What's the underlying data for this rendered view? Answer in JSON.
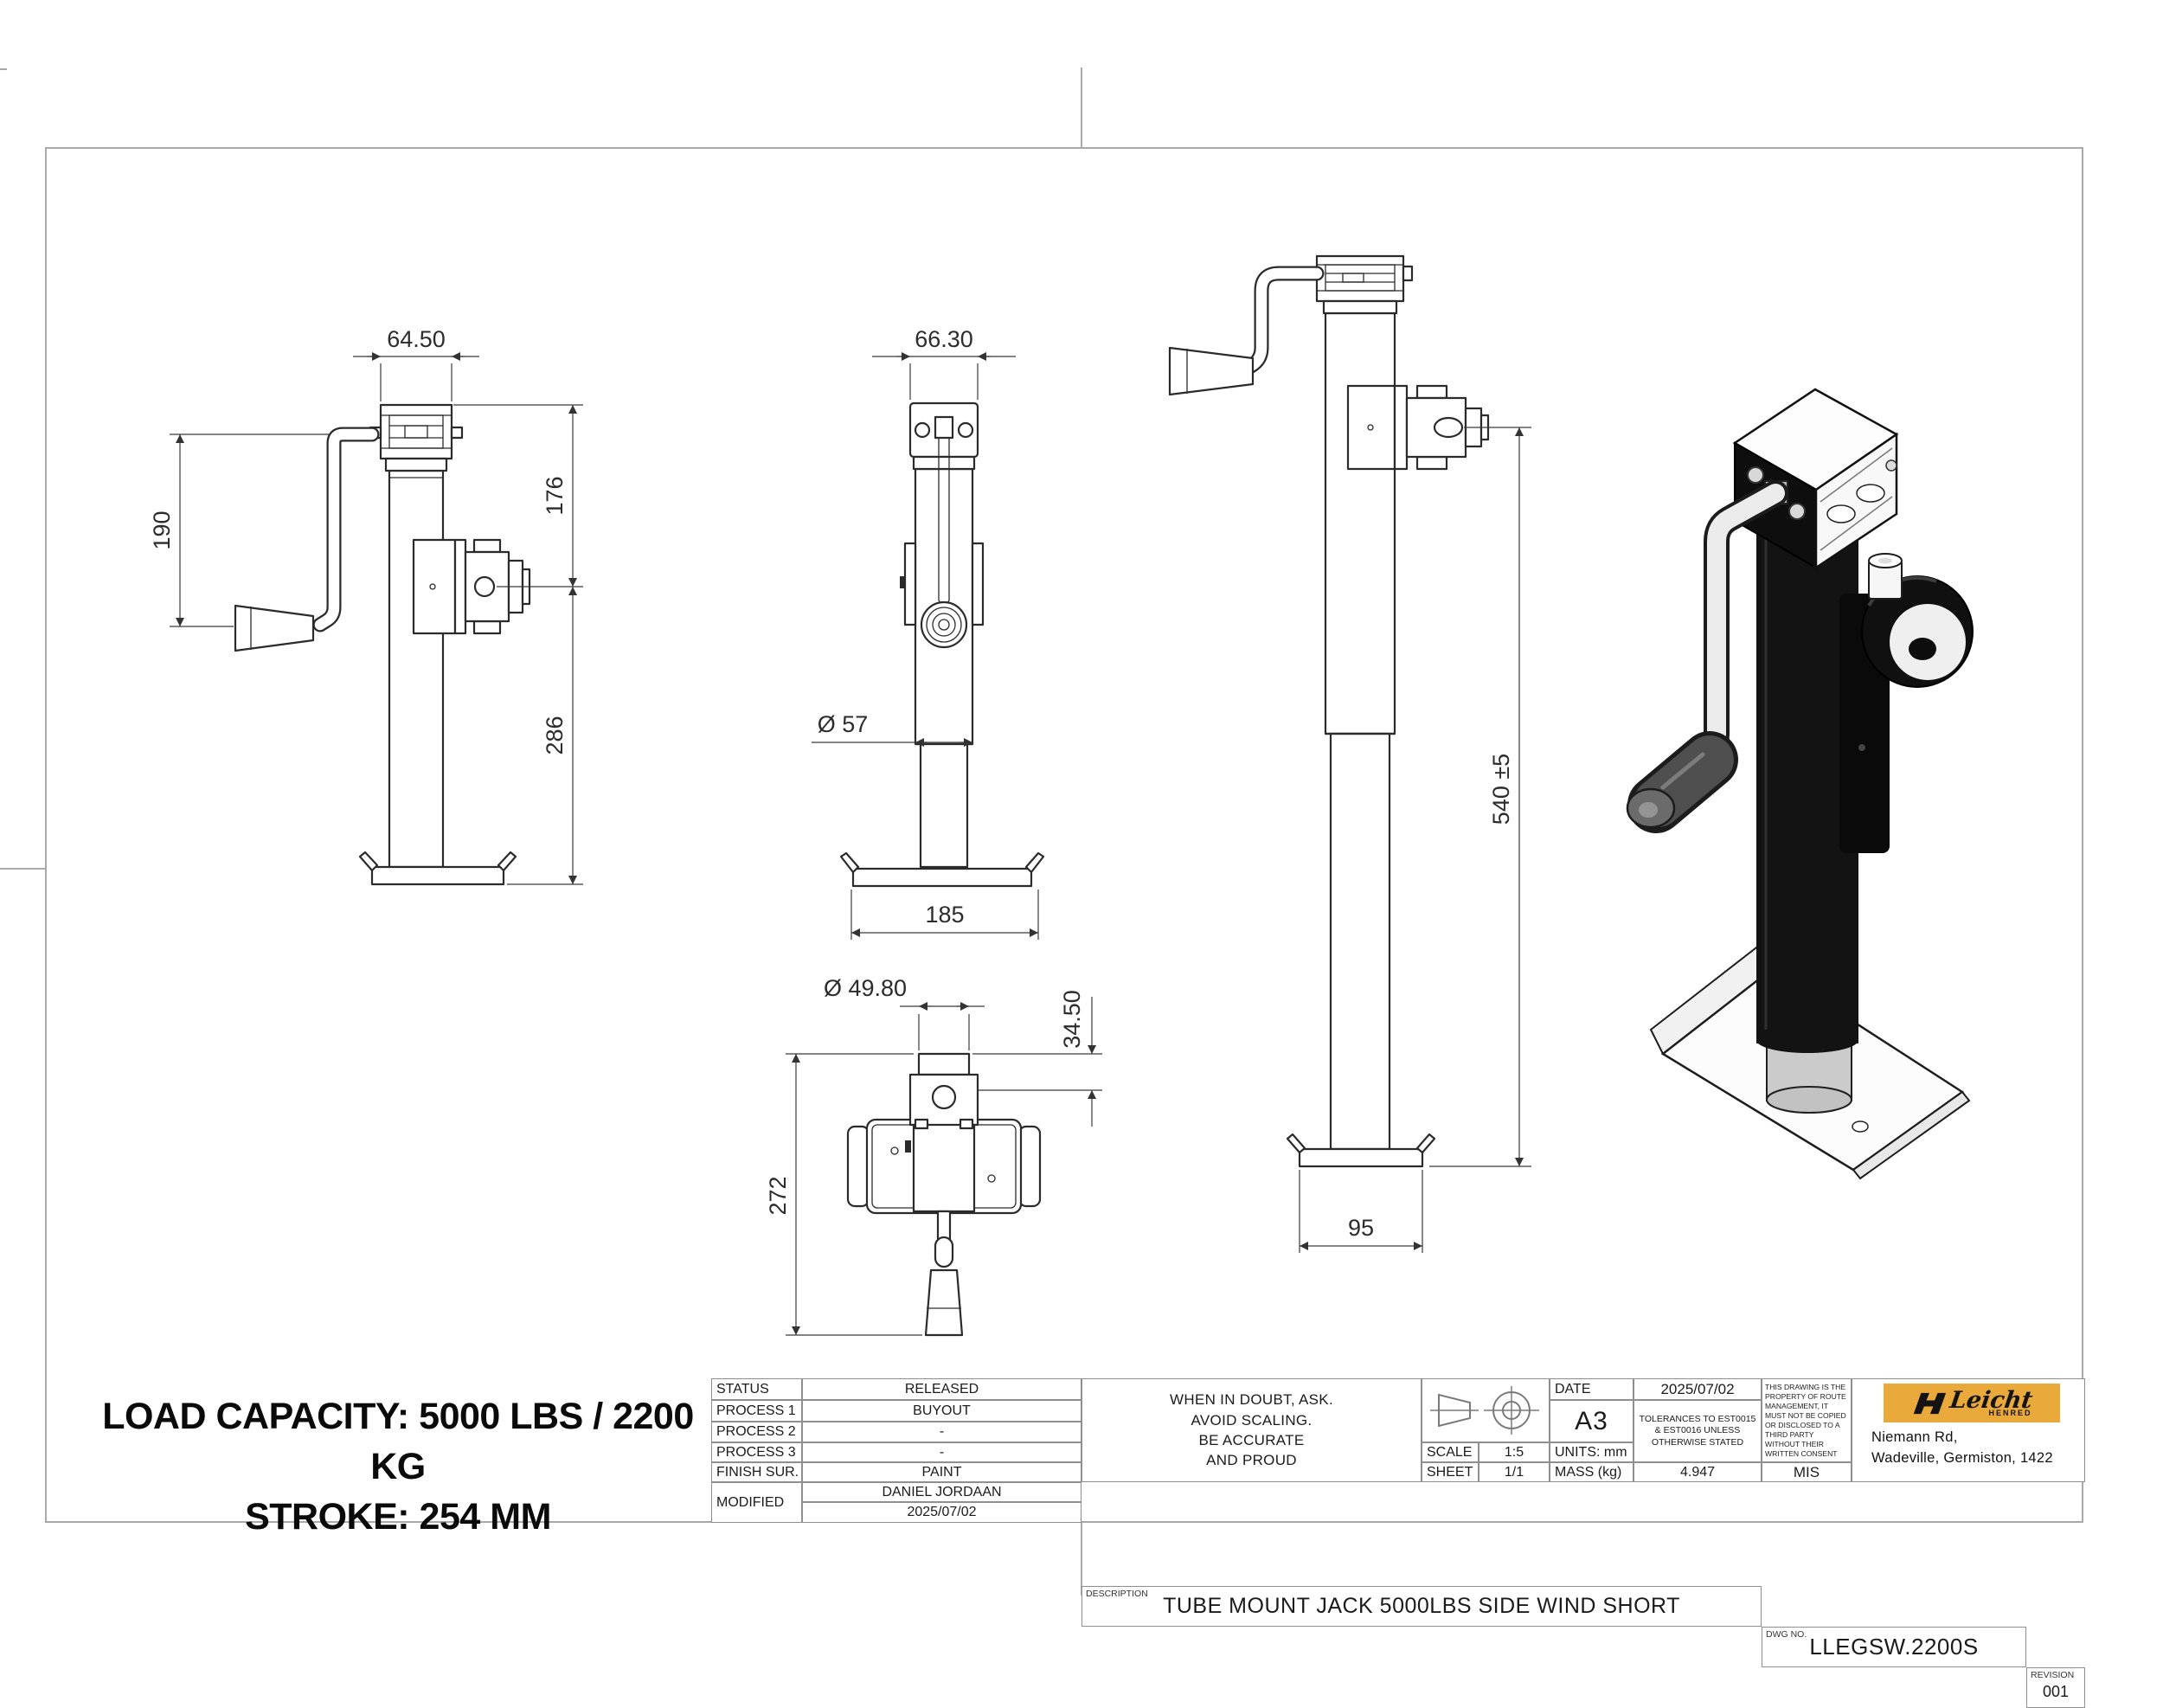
{
  "page": {
    "background": "#ffffff",
    "frame_color": "#a9a9a9",
    "line_color": "#2b2b2b"
  },
  "notes": {
    "load_capacity": "LOAD CAPACITY: 5000 LBS / 2200 KG",
    "stroke": "STROKE: 254 MM"
  },
  "dims": {
    "side": {
      "top_width": "64.50",
      "handle_length": "190",
      "upper_height": "176",
      "lower_height": "286"
    },
    "front": {
      "top_width": "66.30",
      "tube_diameter": "Ø 57",
      "foot_width": "185"
    },
    "extended": {
      "overall_height": "540 ±5",
      "foot_width": "95"
    },
    "top": {
      "tube_diameter": "Ø 49.80",
      "pin_offset": "34.50",
      "overall_length": "272"
    }
  },
  "title_block": {
    "status_label": "STATUS",
    "status": "RELEASED",
    "process1_label": "PROCESS 1",
    "process1": "BUYOUT",
    "process2_label": "PROCESS 2",
    "process2": "-",
    "process3_label": "PROCESS 3",
    "process3": "-",
    "finish_label": "FINISH SUR.",
    "finish": "PAINT",
    "modified_label": "MODIFIED",
    "modified_by": "DANIEL JORDAAN",
    "modified_date": "2025/07/02",
    "motto1": "WHEN IN DOUBT, ASK.",
    "motto2": "AVOID SCALING.",
    "motto3": "BE ACCURATE",
    "motto4": "AND PROUD",
    "scale_label": "SCALE",
    "scale": "1:5",
    "sheet_label": "SHEET",
    "sheet": "1/1",
    "date_label": "DATE",
    "date": "2025/07/02",
    "paper_size": "A3",
    "units_label": "UNITS: mm",
    "mass_label": "MASS (kg)",
    "mass": "4.947",
    "tolerances": "TOLERANCES TO EST0015 & EST0016 UNLESS OTHERWISE STATED",
    "ownership": "THIS DRAWING IS THE PROPERTY OF ROUTE MANAGEMENT, IT MUST NOT BE COPIED OR DISCLOSED TO A THIRD PARTY WITHOUT THEIR WRITTEN CONSENT",
    "mis": "MIS",
    "description_label": "DESCRIPTION",
    "description": "TUBE MOUNT JACK 5000LBS SIDE WIND SHORT",
    "dwg_label": "DWG NO.",
    "dwg_no": "LLEGSW.2200S",
    "revision_label": "REVISION",
    "revision": "001"
  },
  "company": {
    "brand": "Leicht",
    "sub_brand": "HENRED",
    "address_line1": "Niemann Rd,",
    "address_line2": "Wadeville, Germiston, 1422",
    "logo_bg": "#E9A93B"
  }
}
